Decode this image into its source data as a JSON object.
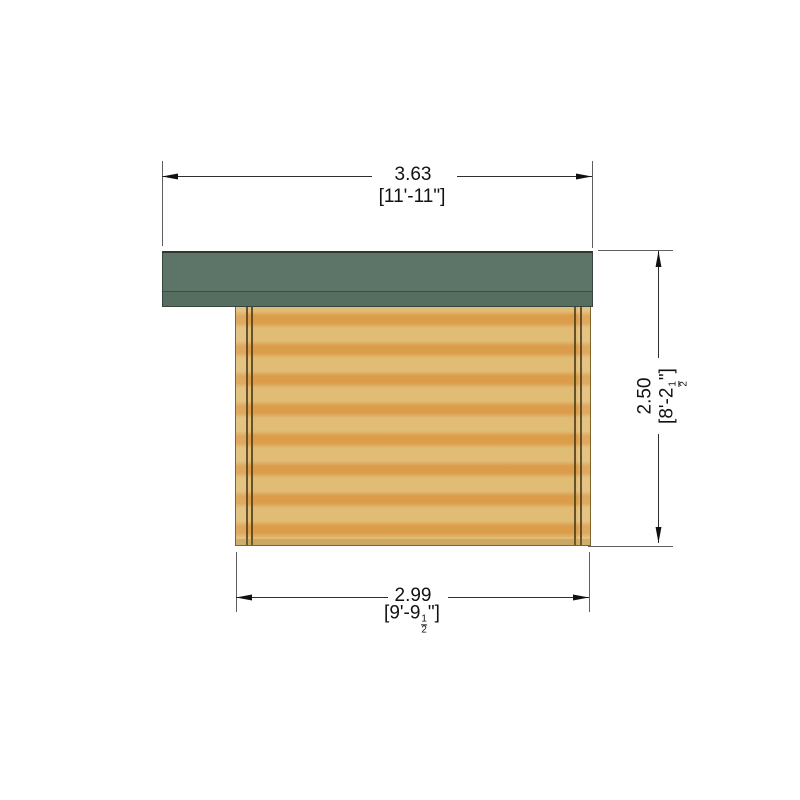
{
  "drawing": {
    "dims": {
      "width_top": {
        "metric": "3.63",
        "imperial": "[11'-11\"]"
      },
      "depth_bottom": {
        "metric": "2.99",
        "imp_prefix": "[9'-9",
        "frac_num": "1",
        "frac_den": "2",
        "imp_suffix": "\"]"
      },
      "height_right": {
        "metric": "2.50",
        "imp_prefix": "[8'-2",
        "frac_num": "1",
        "frac_den": "2",
        "imp_suffix": "\"]"
      }
    }
  },
  "colors": {
    "roof_main": "#5d7468",
    "roof_fascia": "#566e60",
    "roof_edge": "#36453c",
    "wall_light": "#e1bc75",
    "wall_band": "#db9d4a",
    "wall_outline": "#82632a",
    "trim_dark": "#54401a",
    "line_ext": "#5f5f5f",
    "line_dim": "#2e2e2e",
    "text_color": "#121212",
    "bg": "#ffffff"
  }
}
